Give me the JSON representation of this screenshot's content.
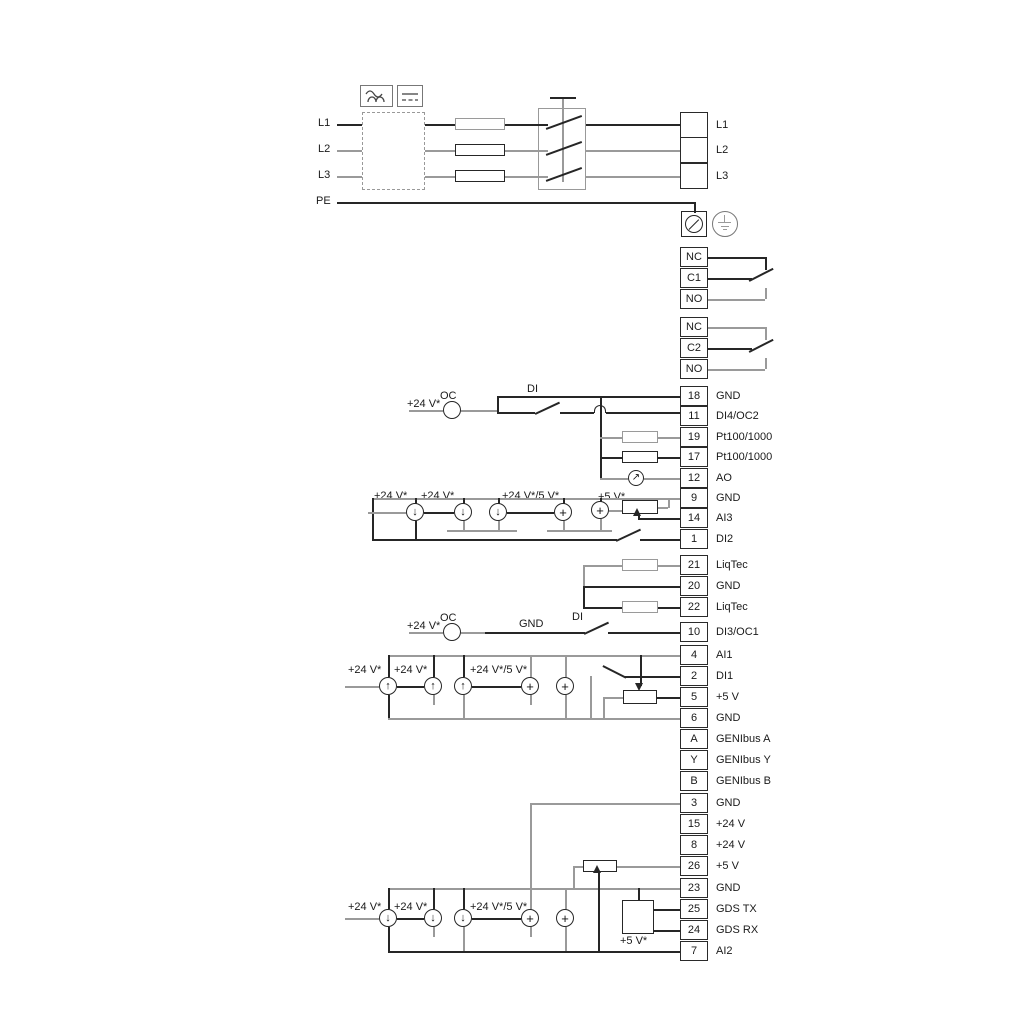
{
  "mains": {
    "inputs": [
      "L1",
      "L2",
      "L3"
    ],
    "pe": "PE",
    "outputs": [
      "L1",
      "L2",
      "L3"
    ]
  },
  "relays": [
    {
      "cells": [
        "NC",
        "C1",
        "NO"
      ]
    },
    {
      "cells": [
        "NC",
        "C2",
        "NO"
      ]
    }
  ],
  "strips": {
    "io_top": [
      {
        "n": "18",
        "t": "GND"
      },
      {
        "n": "11",
        "t": "DI4/OC2"
      },
      {
        "n": "19",
        "t": "Pt100/1000"
      },
      {
        "n": "17",
        "t": "Pt100/1000"
      },
      {
        "n": "12",
        "t": "AO"
      },
      {
        "n": "9",
        "t": "GND"
      },
      {
        "n": "14",
        "t": "AI3"
      },
      {
        "n": "1",
        "t": "DI2"
      }
    ],
    "liqtec": [
      {
        "n": "21",
        "t": "LiqTec"
      },
      {
        "n": "20",
        "t": "GND"
      },
      {
        "n": "22",
        "t": "LiqTec"
      }
    ],
    "io_mid": [
      {
        "n": "10",
        "t": "DI3/OC1"
      },
      {
        "n": "4",
        "t": "AI1"
      },
      {
        "n": "2",
        "t": "DI1"
      },
      {
        "n": "5",
        "t": "+5 V"
      },
      {
        "n": "6",
        "t": "GND"
      },
      {
        "n": "A",
        "t": "GENIbus A"
      },
      {
        "n": "Y",
        "t": "GENIbus Y"
      },
      {
        "n": "B",
        "t": "GENIbus B"
      }
    ],
    "io_bottom": [
      {
        "n": "3",
        "t": "GND"
      },
      {
        "n": "15",
        "t": "+24 V"
      },
      {
        "n": "8",
        "t": "+24 V"
      },
      {
        "n": "26",
        "t": "+5 V"
      },
      {
        "n": "23",
        "t": "GND"
      },
      {
        "n": "25",
        "t": "GDS TX"
      },
      {
        "n": "24",
        "t": "GDS RX"
      },
      {
        "n": "7",
        "t": "AI2"
      }
    ]
  },
  "annotations": {
    "plus24": "+24 V*",
    "oc": "OC",
    "di": "DI",
    "gnd": "GND",
    "plus24or5": "+24 V*/5 V*",
    "plus5": "+5 V*"
  },
  "colors": {
    "wire": "#262626",
    "wire_alt": "#9a9a9a"
  }
}
